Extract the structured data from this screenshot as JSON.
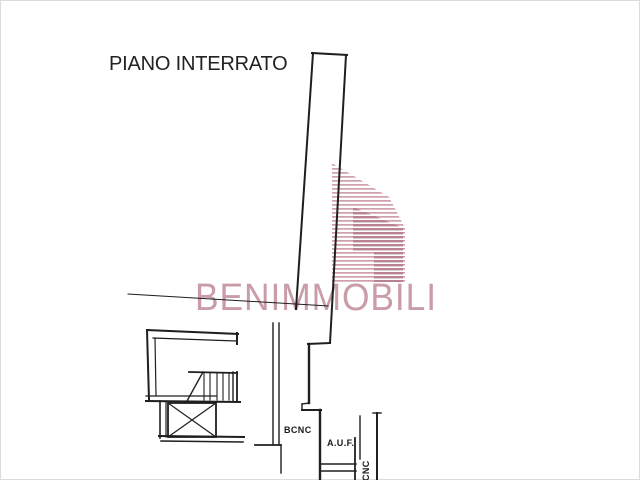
{
  "page": {
    "background": "#ffffff",
    "border_color": "#dcdcdc"
  },
  "plan": {
    "title": "PIANO INTERRATO",
    "line_color": "#1f1f1f",
    "labels": {
      "bcnc": "BCNC",
      "auf": "A.U.F.",
      "cnc_vertical": "CNC"
    },
    "segments": [
      [
        312,
        53,
        347,
        55,
        2
      ],
      [
        313,
        53,
        296,
        309,
        2
      ],
      [
        346,
        55,
        330,
        343,
        2
      ],
      [
        330,
        343,
        308,
        344,
        2
      ],
      [
        309,
        344,
        309,
        403,
        2.4
      ],
      [
        309,
        403,
        302,
        404,
        1.4
      ],
      [
        302,
        404,
        302,
        410,
        1.4
      ],
      [
        302,
        410,
        321,
        410,
        2
      ],
      [
        320,
        410,
        320,
        480,
        2.4
      ],
      [
        321,
        464,
        356,
        464,
        1.4
      ],
      [
        321,
        471,
        356,
        471,
        1.4
      ],
      [
        355,
        438,
        355,
        480,
        1.8
      ],
      [
        360,
        416,
        360,
        459,
        1.4
      ],
      [
        377,
        413,
        377,
        480,
        2
      ],
      [
        373,
        413,
        381,
        413,
        1.4
      ],
      [
        273,
        323,
        273,
        444,
        1.4
      ],
      [
        279,
        323,
        279,
        444,
        1.4
      ],
      [
        255,
        445,
        281,
        445,
        1.8
      ],
      [
        281,
        446,
        281,
        473,
        1.4
      ],
      [
        128,
        294,
        328,
        306,
        1
      ],
      [
        147,
        330,
        238,
        334,
        2
      ],
      [
        153,
        338,
        236,
        341,
        1.2
      ],
      [
        237,
        333,
        237,
        344,
        2
      ],
      [
        147,
        330,
        149,
        400,
        2
      ],
      [
        155,
        338,
        156,
        395,
        1.2
      ],
      [
        146,
        396,
        216,
        396,
        1.2
      ],
      [
        146,
        401,
        240,
        402,
        2
      ],
      [
        160,
        401,
        160,
        438,
        1.6
      ],
      [
        166,
        401,
        166,
        437,
        1.2
      ],
      [
        159,
        436,
        244,
        437,
        2
      ],
      [
        161,
        441,
        243,
        442,
        1.6
      ],
      [
        168,
        403,
        216,
        437,
        1.2
      ],
      [
        216,
        403,
        168,
        437,
        1.2
      ],
      [
        189,
        372,
        237,
        373,
        1.8
      ],
      [
        203,
        372,
        187,
        401,
        1.4
      ],
      [
        204,
        373,
        204,
        400,
        1.1
      ],
      [
        210,
        373,
        210,
        400,
        1.1
      ],
      [
        217,
        373,
        217,
        400,
        1.1
      ],
      [
        223,
        373,
        223,
        400,
        1.1
      ],
      [
        229,
        373,
        229,
        400,
        1.1
      ],
      [
        233,
        372,
        233,
        401,
        1.4
      ],
      [
        237,
        372,
        237,
        401,
        1.8
      ]
    ],
    "rects": [
      {
        "x": 168,
        "y": 403,
        "w": 48,
        "h": 34,
        "stroke": 1.8
      }
    ]
  },
  "watermark": {
    "text": "BENIMMOBILI",
    "text_color": "#c99ca7",
    "logo": {
      "stripe_light": "#cfa0ab",
      "stripe_dark": "#b9828f",
      "polys_light": [
        [
          [
            332,
            163
          ],
          [
            389,
            197
          ],
          [
            332,
            197
          ]
        ],
        [
          [
            332,
            197
          ],
          [
            389,
            197
          ],
          [
            405,
            228
          ],
          [
            405,
            283
          ],
          [
            332,
            283
          ]
        ]
      ],
      "polys_dark": [
        [
          [
            353,
            207
          ],
          [
            403,
            228
          ],
          [
            403,
            252
          ],
          [
            353,
            252
          ]
        ],
        [
          [
            374,
            252
          ],
          [
            403,
            252
          ],
          [
            403,
            282
          ],
          [
            374,
            282
          ]
        ]
      ]
    }
  }
}
